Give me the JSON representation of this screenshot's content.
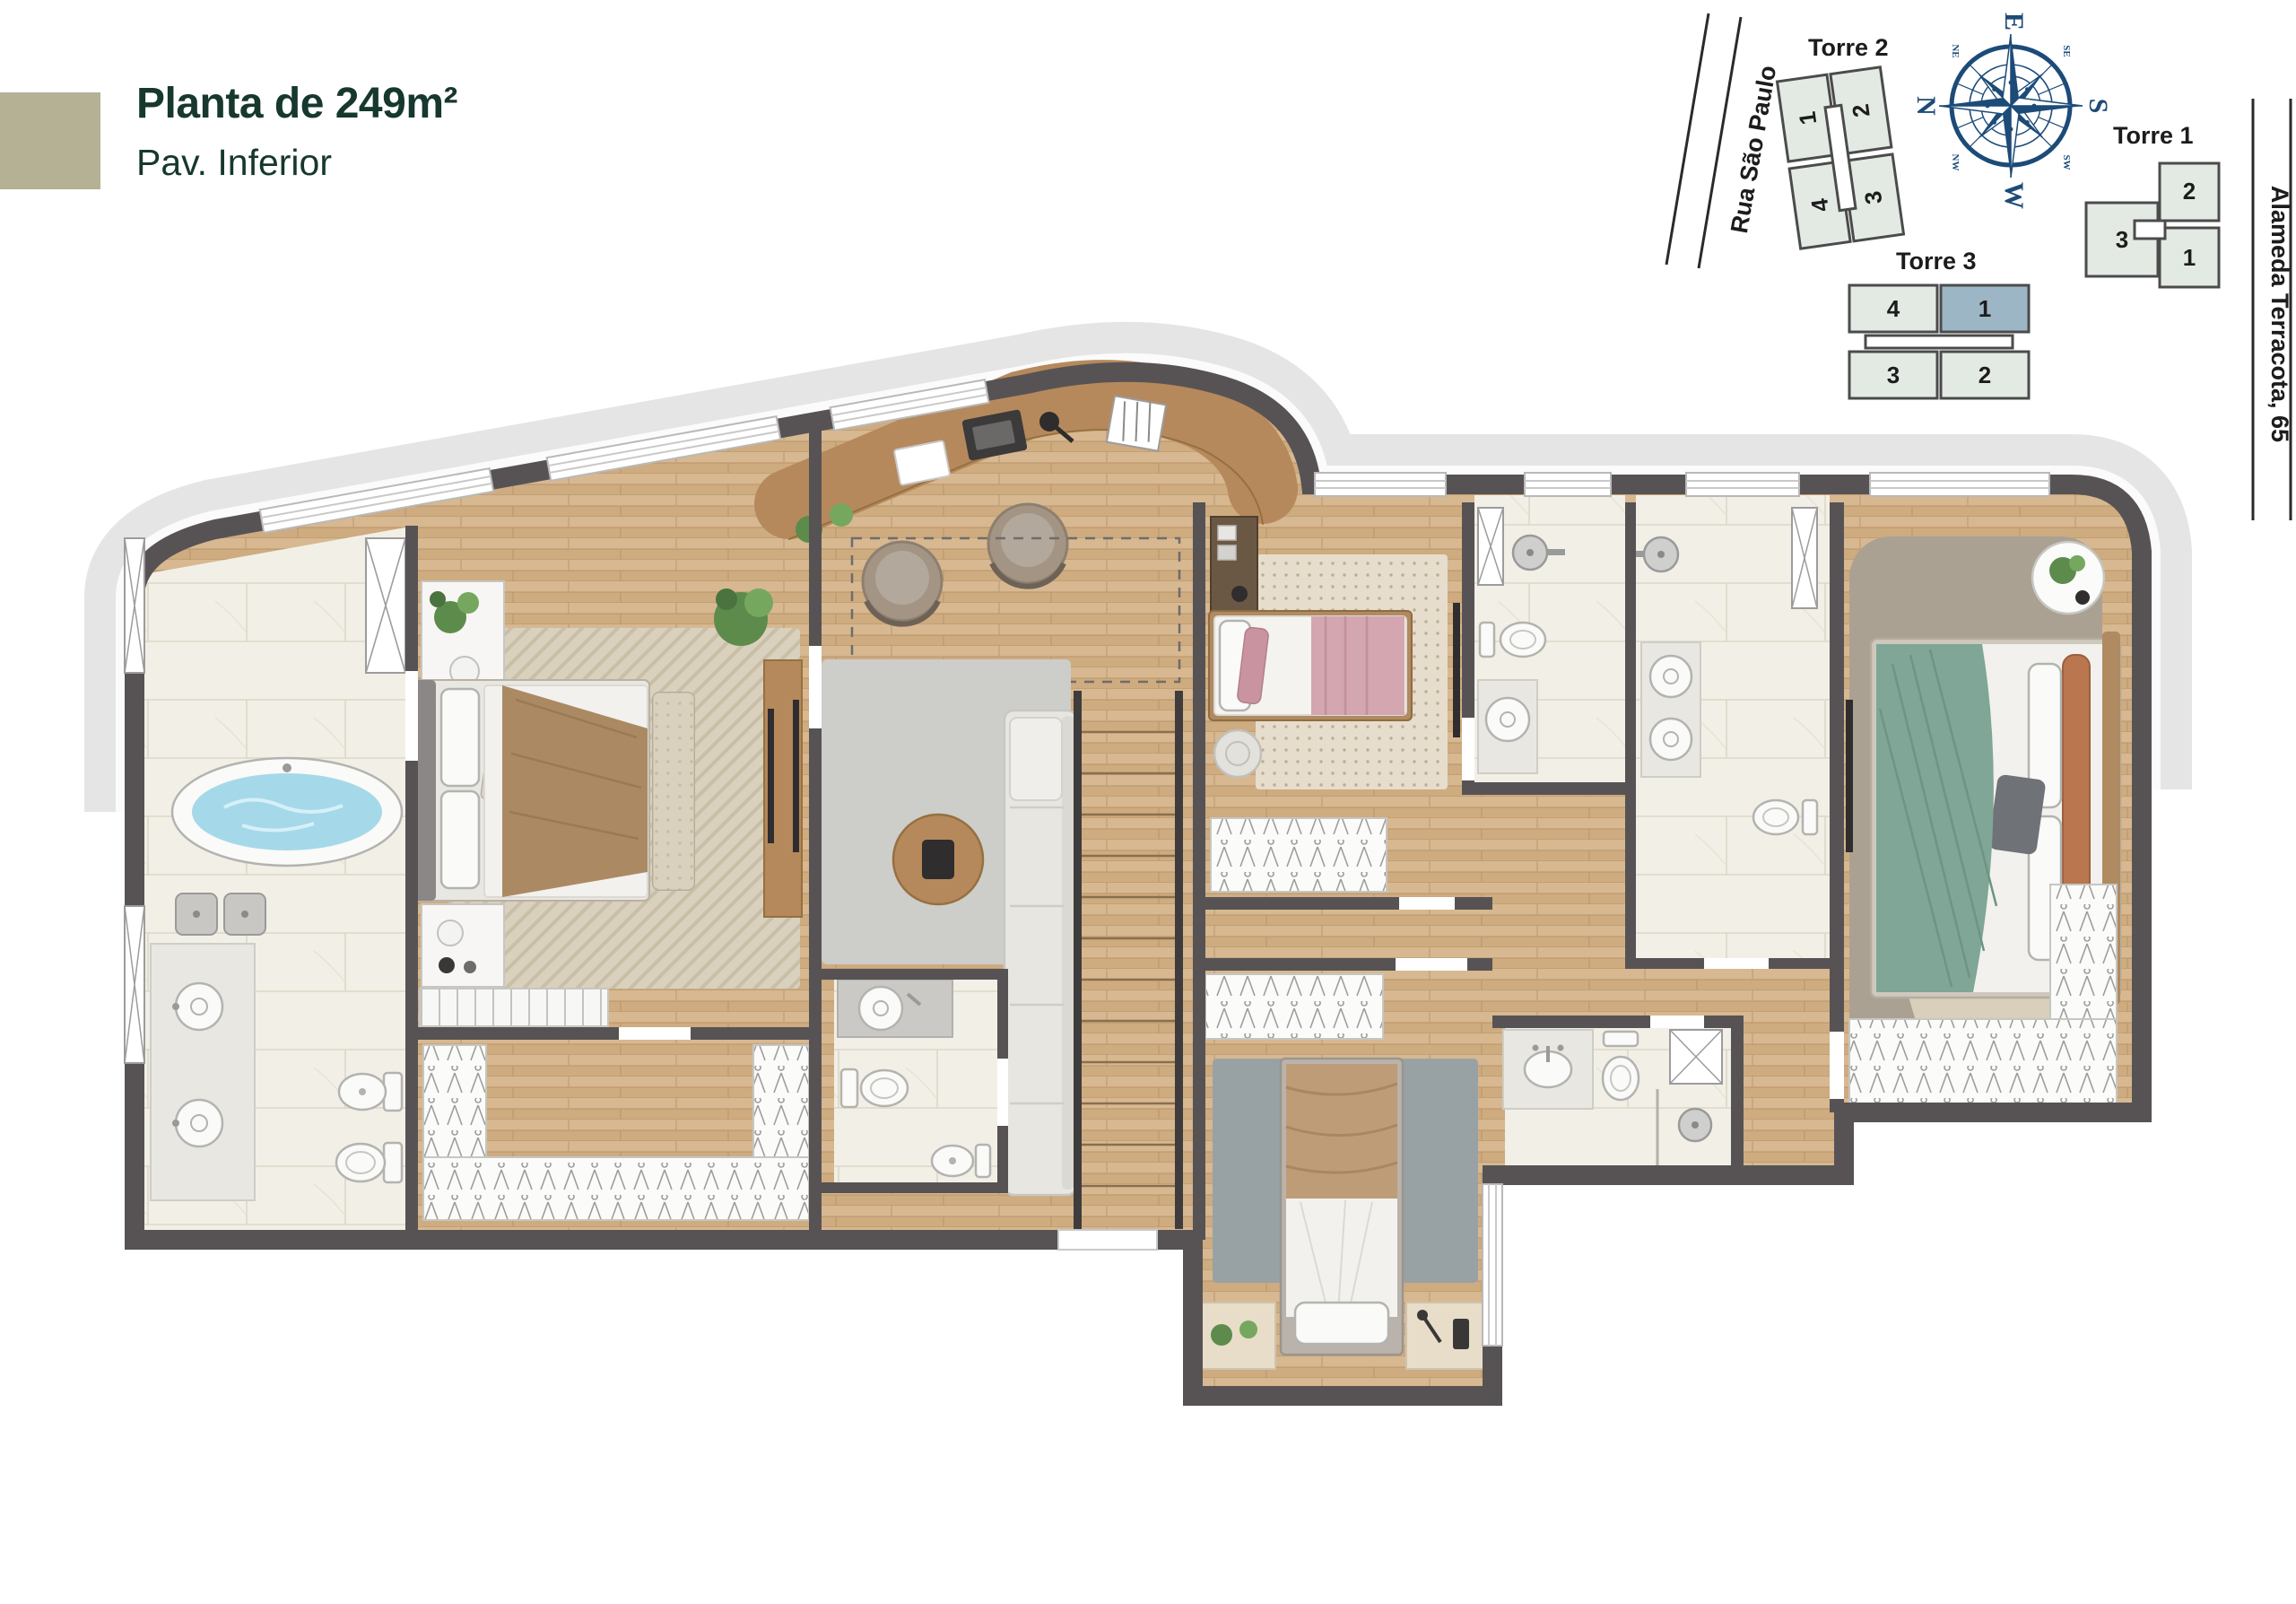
{
  "header": {
    "title": "Planta de 249m²",
    "subtitle": "Pav. Inferior",
    "accent_color": "#b4b195",
    "text_color": "#16382e"
  },
  "site_plan": {
    "streets": [
      {
        "name": "Rua São Paulo"
      },
      {
        "name": "Alameda Terracota, 65"
      }
    ],
    "towers": [
      {
        "label": "Torre 2",
        "units": [
          "1",
          "2",
          "4",
          "3"
        ]
      },
      {
        "label": "Torre 1",
        "units": [
          "2",
          "3",
          "1"
        ]
      },
      {
        "label": "Torre 3",
        "units": [
          "4",
          "1",
          "3",
          "2"
        ],
        "highlighted_unit": "1"
      }
    ],
    "compass": {
      "north": "N",
      "east": "E",
      "south": "S",
      "west": "W",
      "ne": "NE",
      "se": "SE",
      "sw": "SW",
      "nw": "NW",
      "north_color": "#e02b20",
      "rose_color": "#1d4b78"
    },
    "colors": {
      "footprint": "#e3eae4",
      "outline": "#4b4b4b",
      "highlight": "#9cb6c5"
    }
  },
  "floor_plan": {
    "colors": {
      "walls": "#575355",
      "wood_floor": "#d3b28a",
      "desk_wood": "#b5895c",
      "marble": "#f2efe6",
      "terrace_band": "#e5e5e5",
      "rug_gray": "#cdcdca",
      "rug_beige": "#d9d0bd",
      "rug_slate": "#98a2a4",
      "bath_water": "#a5d9e9",
      "throw_green": "#7fa696",
      "blanket_pink": "#d4a6af",
      "blanket_tan": "#bd9c77",
      "fixtures": "#fafaf8"
    }
  }
}
